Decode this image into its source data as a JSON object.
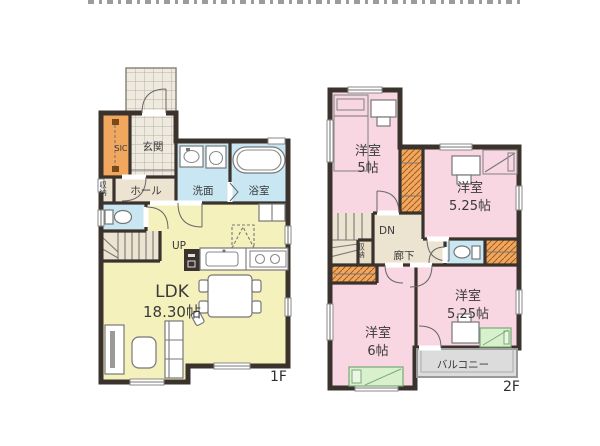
{
  "floor1": {
    "floor_label": "1F",
    "ldk": {
      "name": "LDK",
      "size": "18.30帖"
    },
    "genkan": "玄関",
    "sic": "SIC",
    "hall": "ホール",
    "storage": "収納",
    "washroom": "洗面",
    "bathroom": "浴室",
    "stairs": "UP"
  },
  "floor2": {
    "floor_label": "2F",
    "bedroom_a": {
      "name": "洋室",
      "size": "5帖"
    },
    "bedroom_b": {
      "name": "洋室",
      "size": "5.25帖"
    },
    "bedroom_c": {
      "name": "洋室",
      "size": "5.25帖"
    },
    "bedroom_d": {
      "name": "洋室",
      "size": "6帖"
    },
    "corridor": "廊下",
    "storage": "収納",
    "stairs": "DN",
    "balcony": "バルコニー"
  },
  "colors": {
    "wall": "#3a322d",
    "ldk_yellow": "#f5f1bd",
    "room_pink": "#f8d6e2",
    "water_blue": "#c9e7f2",
    "closet_orange": "#f2a75e",
    "hall_beige": "#ece3d1",
    "tile_gray": "#efeae0",
    "balcony_gray": "#dcdcdc",
    "bed_green": "#d9f0cd"
  }
}
